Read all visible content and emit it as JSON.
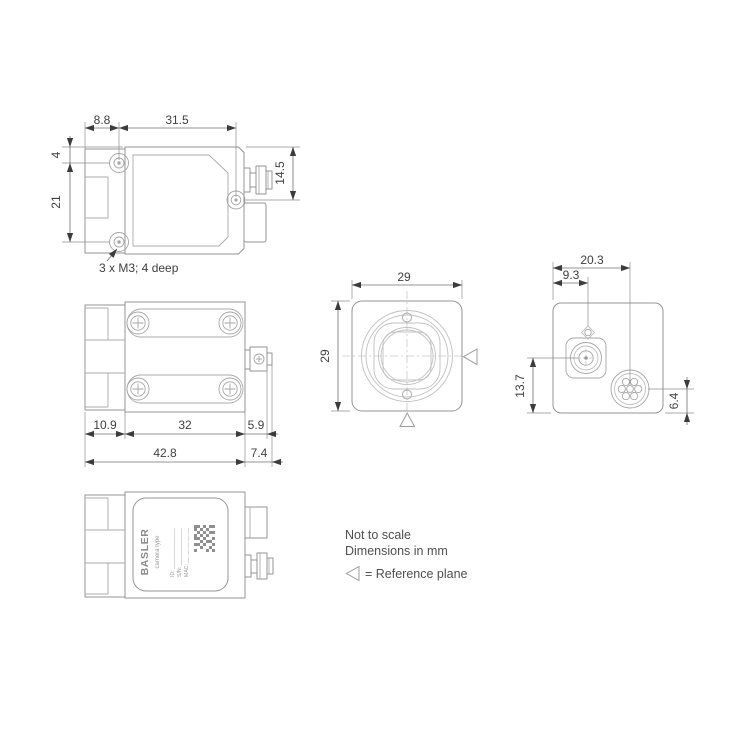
{
  "drawing": {
    "top_view": {
      "dim_offset_x": "8.8",
      "dim_spacing_x": "31.5",
      "dim_offset_y": "4",
      "dim_spacing_y": "21",
      "dim_connector_height": "14.5",
      "thread_callout": "3 x M3; 4 deep"
    },
    "side_view": {
      "dim_front": "10.9",
      "dim_body": "32",
      "dim_connector": "5.9",
      "dim_total": "42.8",
      "dim_connector_total": "7.4"
    },
    "front_view": {
      "dim_width": "29",
      "dim_height": "29"
    },
    "back_view": {
      "dim_connector_x": "20.3",
      "dim_lens_x": "9.3",
      "dim_lens_y": "13.7",
      "dim_connector_y": "6.4"
    },
    "label": {
      "brand": "BASLER",
      "camera_type": "camera type",
      "id_line": "ID: ______________",
      "sn_line": "S/N: _____________",
      "mac_line": "MAC: __ __ __ __ __"
    },
    "notes": {
      "not_to_scale": "Not to scale",
      "dimensions_unit": "Dimensions in mm",
      "reference_plane": "= Reference plane"
    },
    "colors": {
      "outline": "#949494",
      "dimension_text": "#3f3f3f",
      "arrow": "#3c3c3c",
      "note_text": "#4f4f4f"
    }
  }
}
